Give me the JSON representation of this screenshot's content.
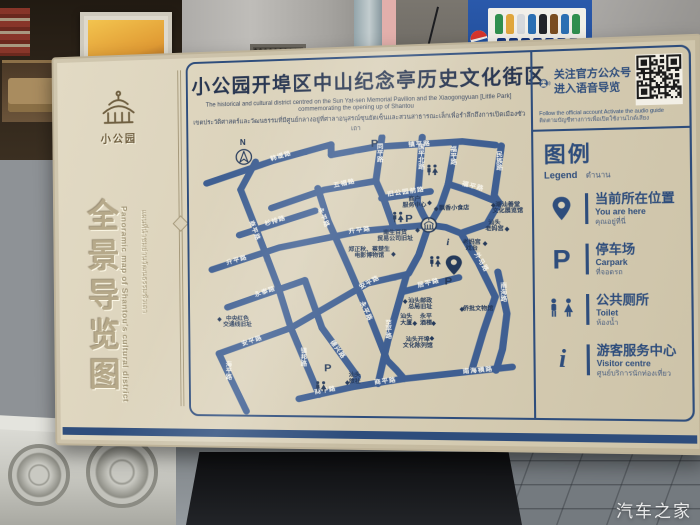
{
  "scene": {
    "watermark": "汽车之家",
    "vending_service_number": "4006999517"
  },
  "sign": {
    "left_panel": {
      "brand": "小公园",
      "title_cn": "全景导览图",
      "title_en": "Panoramic map of Shantou's cultural district",
      "title_th": "แผนที่นำชมย่านวัฒนธรรมซัวเถา"
    },
    "header": {
      "title": "小公园开埠区中山纪念亭历史文化街区",
      "subtitle_en": "The historical and cultural district centred on the Sun Yat-sen Memorial Pavilion and the Xiaogongyuan [Little Park] commemorating the opening up of Shantou",
      "subtitle_th": "เขตประวัติศาสตร์และวัฒนธรรมที่มีศูนย์กลางอยู่ที่ศาลาอนุสรณ์ซุนยัตเซ็นและสวนสาธารณะเล็กเพื่อรำลึกถึงการเปิดเมืองซัวเถา"
    },
    "qr": {
      "line1": "关注官方公众号",
      "line2": "进入语音导览",
      "caption_en": "Follow the official account Activate the audio guide",
      "caption_th": "ติดตามบัญชีทางการเพื่อเปิดใช้งานไกด์เสียง",
      "icon": "audio-guide-icon",
      "qr_icon": "qr-code"
    },
    "legend": {
      "title_cn": "图例",
      "title_en": "Legend",
      "title_th": "ตำนาน",
      "items": [
        {
          "icon": "you-are-here-pin",
          "cn": "当前所在位置",
          "en": "You are here",
          "th": "คุณอยู่ที่นี่"
        },
        {
          "icon": "parking",
          "glyph": "P",
          "cn": "停车场",
          "en": "Carpark",
          "th": "ที่จอดรถ"
        },
        {
          "icon": "toilet",
          "cn": "公共厕所",
          "en": "Toilet",
          "th": "ห้องน้ำ"
        },
        {
          "icon": "info",
          "glyph": "i",
          "cn": "游客服务中心",
          "en": "Visitor centre",
          "th": "ศูนย์บริการนักท่องเที่ยว"
        }
      ]
    },
    "map": {
      "compass_label": "N",
      "road_color": "#3f5f92",
      "label_color": "#f7f4ea",
      "poi_color": "#24395a",
      "roads": [
        {
          "name": "韩堤路",
          "path": "M20,52 L95,27 L158,10",
          "labels": [
            {
              "x": 103,
              "y": 22,
              "r": -17
            }
          ]
        },
        {
          "name": "镇平路",
          "path": "M158,22 L205,14 L298,10 L333,15",
          "labels": [
            {
              "x": 253,
              "y": 12,
              "r": -2
            }
          ]
        },
        {
          "name": "",
          "path": "M158,10 L158,22"
        },
        {
          "name": "同平路",
          "path": "M213,3 L206,53",
          "vlabels": [
            {
              "x": 211,
              "y": 16
            }
          ]
        },
        {
          "name": "国平北路",
          "path": "M256,4 L250,78",
          "vlabels": [
            {
              "x": 255,
              "y": 18
            }
          ]
        },
        {
          "name": "福平路",
          "path": "M291,12 L283,58",
          "vlabels": [
            {
              "x": 289,
              "y": 21
            }
          ]
        },
        {
          "name": "福平路",
          "path": "M283,58 L310,68 L336,80",
          "labels": [
            {
              "x": 309,
              "y": 61,
              "r": 16
            }
          ]
        },
        {
          "name": "民族路",
          "path": "M339,16 L331,72 L336,80",
          "vlabels": [
            {
              "x": 337,
              "y": 28
            }
          ]
        },
        {
          "name": "五福路",
          "path": "M92,82 L150,62 L206,53",
          "labels": [
            {
              "x": 172,
              "y": 55,
              "r": -11
            }
          ]
        },
        {
          "name": "杉排路",
          "path": "M56,113 L140,86",
          "labels": [
            {
              "x": 96,
              "y": 97,
              "r": -17
            }
          ]
        },
        {
          "name": "旧公园前路",
          "path": "M212,73 L264,66",
          "labels": [
            {
              "x": 238,
              "y": 66,
              "r": -7
            }
          ]
        },
        {
          "name": "商平路",
          "path": "M58,60 L78,115 L98,172",
          "labels": [
            {
              "x": 73,
              "y": 108,
              "r": 71
            }
          ]
        },
        {
          "name": "",
          "path": "M75,28 L58,60"
        },
        {
          "name": "永平路",
          "path": "M143,60 L154,98 L176,152 L198,208 L216,258",
          "labels": [
            {
              "x": 149,
              "y": 94,
              "r": 70
            },
            {
              "x": 194,
              "y": 202,
              "r": 67
            }
          ]
        },
        {
          "name": "升平路",
          "path": "M25,153 L100,128 L190,110 L262,104",
          "labels": [
            {
              "x": 53,
              "y": 142,
              "r": -16
            },
            {
              "x": 188,
              "y": 109,
              "r": -7
            }
          ]
        },
        {
          "name": "永泰路",
          "path": "M42,197 L128,166",
          "labels": [
            {
              "x": 84,
              "y": 179,
              "r": -19
            }
          ]
        },
        {
          "name": "安平路",
          "path": "M32,251 L112,221 L196,170 L238,160",
          "labels": [
            {
              "x": 69,
              "y": 236,
              "r": -19
            },
            {
              "x": 198,
              "y": 169,
              "r": -29
            }
          ]
        },
        {
          "name": "至平路",
          "path": "M238,160 L217,236 L206,285",
          "vlabels": [
            {
              "x": 218,
              "y": 218
            }
          ]
        },
        {
          "name": "镇邦路",
          "path": "M119,239 L142,298",
          "vlabels": [
            {
              "x": 126,
              "y": 250
            }
          ]
        },
        {
          "name": "德兴路",
          "path": "M146,221 L184,277",
          "labels": [
            {
              "x": 163,
              "y": 246,
              "r": 56
            }
          ]
        },
        {
          "name": "商平路",
          "path": "M120,303 L178,289 L234,279",
          "labels": [
            {
              "x": 149,
              "y": 293,
              "r": -11
            },
            {
              "x": 214,
              "y": 282,
              "r": -8
            }
          ]
        },
        {
          "name": "南海横路",
          "path": "M234,279 L348,265",
          "labels": [
            {
              "x": 312,
              "y": 269,
              "r": -6
            }
          ]
        },
        {
          "name": "外马路",
          "path": "M296,114 L314,148 L331,186",
          "labels": [
            {
              "x": 317,
              "y": 147,
              "r": 62
            }
          ]
        },
        {
          "name": "南海路",
          "path": "M334,158 L343,205 L338,245 L331,269",
          "vlabels": [
            {
              "x": 340,
              "y": 176
            }
          ]
        },
        {
          "name": "居平路",
          "path": "M233,180 L293,164",
          "labels": [
            {
              "x": 261,
              "y": 170,
              "r": -14
            }
          ]
        },
        {
          "name": "海平路",
          "path": "M32,251 L48,287 L62,318",
          "vlabels": [
            {
              "x": 43,
              "y": 266
            }
          ]
        },
        {
          "name": "",
          "path": "M206,53 L214,73 L224,104"
        },
        {
          "name": "",
          "path": "M250,78 L256,92 L262,104"
        },
        {
          "name": "",
          "path": "M283,58 L275,82 L265,100"
        },
        {
          "name": "",
          "path": "M262,104 L251,138 L240,159"
        },
        {
          "name": "",
          "path": "M296,114 L280,107 L262,104"
        },
        {
          "name": "",
          "path": "M336,80 L323,104 L298,113"
        },
        {
          "name": "",
          "path": "M331,186 L318,226 L306,268"
        },
        {
          "name": "",
          "path": "M216,258 L226,269 L234,279"
        },
        {
          "name": "",
          "path": "M128,166 L146,221"
        },
        {
          "name": "",
          "path": "M112,221 L119,239"
        },
        {
          "name": "",
          "path": "M98,172 L112,221"
        },
        {
          "name": "",
          "path": "M184,277 L178,289"
        }
      ],
      "pois": [
        {
          "lines": [
            "商户",
            "服务中心"
          ],
          "x": 247,
          "y": 76,
          "dx": 263,
          "dy": 79
        },
        {
          "lines": [
            "飘香小食店"
          ],
          "x": 289,
          "y": 87,
          "dx": 270,
          "dy": 86
        },
        {
          "lines": [
            "潮汕善堂",
            "文化展览馆"
          ],
          "x": 345,
          "y": 84,
          "dx": 330,
          "dy": 83
        },
        {
          "lines": [
            "汕头",
            "老妈宫"
          ],
          "x": 331,
          "y": 104,
          "dx": 344,
          "dy": 110
        },
        {
          "lines": [
            "老妈宫",
            "戏台"
          ],
          "x": 307,
          "y": 126,
          "dx": 321,
          "dy": 126
        },
        {
          "lines": [
            "南生百货",
            "贸易公司旧址"
          ],
          "x": 226,
          "y": 114,
          "dx": 250,
          "dy": 110
        },
        {
          "lines": [
            "郑正秋、蔡楚生",
            "电影博物馆"
          ],
          "x": 198,
          "y": 133,
          "dx": 224,
          "dy": 137
        },
        {
          "lines": [
            "中央红色",
            "交通线旧址"
          ],
          "x": 53,
          "y": 212,
          "dx": 33,
          "dy": 211
        },
        {
          "lines": [
            "汕头邮政",
            "总局旧址"
          ],
          "x": 252,
          "y": 192,
          "dx": 236,
          "dy": 191
        },
        {
          "lines": [
            "侨批文物馆"
          ],
          "x": 313,
          "y": 201,
          "dx": 296,
          "dy": 200
        },
        {
          "lines": [
            "汕头",
            "大厦"
          ],
          "x": 237,
          "y": 210,
          "dx": 246,
          "dy": 216
        },
        {
          "lines": [
            "永平",
            "酒楼"
          ],
          "x": 258,
          "y": 210,
          "dx": 266,
          "dy": 216
        },
        {
          "lines": [
            "汕头开埠",
            "文化陈列馆"
          ],
          "x": 249,
          "y": 236,
          "dx": 264,
          "dy": 233
        },
        {
          "lines": [
            "汕头",
            "旅社"
          ],
          "x": 181,
          "y": 277,
          "dx": 173,
          "dy": 284
        }
      ],
      "markers": [
        {
          "icon": "north-compass",
          "x": 62,
          "y": 20
        },
        {
          "icon": "parking",
          "x": 205,
          "y": 10
        },
        {
          "icon": "toilet",
          "x": 266,
          "y": 42
        },
        {
          "icon": "toilet",
          "x": 229,
          "y": 95
        },
        {
          "icon": "parking",
          "x": 241,
          "y": 96
        },
        {
          "icon": "pavilion",
          "x": 262,
          "y": 104
        },
        {
          "icon": "info",
          "x": 282,
          "y": 123
        },
        {
          "icon": "toilet",
          "x": 268,
          "y": 146
        },
        {
          "icon": "you-are-here-pin",
          "x": 288,
          "y": 150
        },
        {
          "icon": "parking",
          "x": 282,
          "y": 168
        },
        {
          "icon": "parking",
          "x": 152,
          "y": 267
        },
        {
          "icon": "toilet",
          "x": 144,
          "y": 289
        }
      ]
    }
  }
}
